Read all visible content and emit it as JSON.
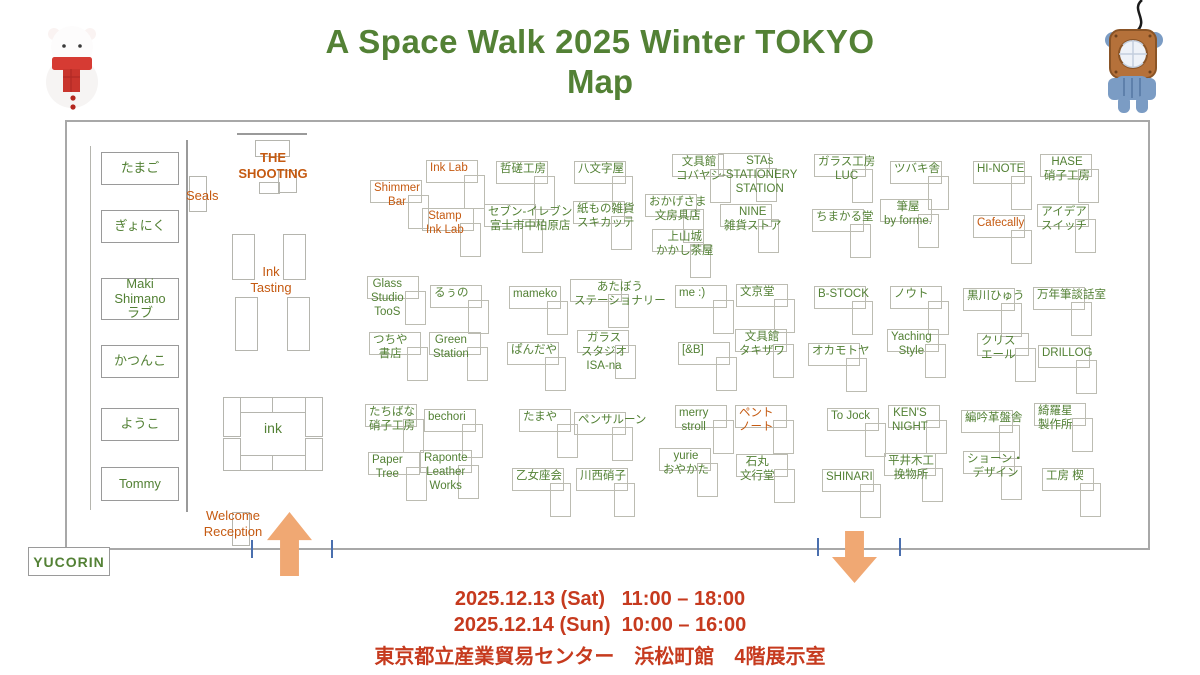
{
  "title": {
    "line1": "A Space Walk 2025 Winter TOKYO",
    "line2": "Map"
  },
  "colors": {
    "green": "#538135",
    "orange": "#c55a11",
    "red": "#c63a1e",
    "arrow_fill": "#f0a873",
    "tick_blue": "#4a6fae",
    "border_gray": "#a8a8a8"
  },
  "footer": {
    "date_sat": "2025.12.13 (Sat)   11:00 – 18:00",
    "date_sun": "2025.12.14 (Sun)  10:00 – 16:00",
    "venue": "東京都立産業貿易センター　浜松町館　4階展示室"
  },
  "map": {
    "labels": {
      "seals": "Seals",
      "shooting": "THE\nSHOOTING",
      "ink_tasting": "Ink\nTasting",
      "ink_table": "ink",
      "welcome": "Welcome\nReception",
      "yucorin": "YUCORIN"
    },
    "left_column": [
      {
        "label": "たまご",
        "y": 152,
        "h": 33
      },
      {
        "label": "ぎょにく",
        "y": 210,
        "h": 33
      },
      {
        "label": "Maki Shimano\nラブ",
        "y": 278,
        "h": 42
      },
      {
        "label": "かつんこ",
        "y": 345,
        "h": 33
      },
      {
        "label": "ようこ",
        "y": 408,
        "h": 33
      },
      {
        "label": "Tommy",
        "y": 467,
        "h": 34
      }
    ],
    "booths": [
      {
        "name": "Ink Lab",
        "color": "orange",
        "x": 430,
        "y": 162
      },
      {
        "name": "哲磋工房",
        "color": "green",
        "x": 500,
        "y": 163
      },
      {
        "name": "八文字屋",
        "color": "green",
        "x": 578,
        "y": 163
      },
      {
        "name": "文具館\nコバヤシ",
        "color": "green",
        "x": 676,
        "y": 156
      },
      {
        "name": "STAs\n-STATIONERY\nSTATION",
        "color": "green",
        "x": 722,
        "y": 155
      },
      {
        "name": "ガラス工房\nLUC",
        "color": "green",
        "x": 818,
        "y": 156
      },
      {
        "name": "ツバキ舎",
        "color": "green",
        "x": 894,
        "y": 163
      },
      {
        "name": "HI-NOTE",
        "color": "green",
        "x": 977,
        "y": 163
      },
      {
        "name": "HASE\n硝子工房",
        "color": "green",
        "x": 1044,
        "y": 156
      },
      {
        "name": "Shimmer\nBar",
        "color": "orange",
        "x": 374,
        "y": 182
      },
      {
        "name": "Stamp\nInk Lab",
        "color": "orange",
        "x": 426,
        "y": 210
      },
      {
        "name": "セブン‐イレブン\n富士市中柏原店",
        "color": "green",
        "x": 488,
        "y": 206
      },
      {
        "name": "紙もの雑貨\nスキカッテ",
        "color": "green",
        "x": 577,
        "y": 203
      },
      {
        "name": "おかげさま\n文房具店",
        "color": "green",
        "x": 649,
        "y": 196
      },
      {
        "name": "上山城\nかかし茶屋",
        "color": "green",
        "x": 656,
        "y": 231
      },
      {
        "name": "NINE\n雑貨ストア",
        "color": "green",
        "x": 724,
        "y": 206
      },
      {
        "name": "ちまかる堂",
        "color": "green",
        "x": 816,
        "y": 211
      },
      {
        "name": "筆屋\nby forme.",
        "color": "green",
        "x": 884,
        "y": 201
      },
      {
        "name": "Cafecally",
        "color": "orange",
        "x": 977,
        "y": 217
      },
      {
        "name": "アイデア\nスイッチ",
        "color": "green",
        "x": 1041,
        "y": 206
      },
      {
        "name": "Glass\nStudio\nTooS",
        "color": "green",
        "x": 371,
        "y": 278
      },
      {
        "name": "るぅの",
        "color": "green",
        "x": 434,
        "y": 287
      },
      {
        "name": "mameko",
        "color": "green",
        "x": 513,
        "y": 288
      },
      {
        "name": "あたぼう\nステーショナリー",
        "color": "green",
        "x": 574,
        "y": 281
      },
      {
        "name": "me :)",
        "color": "green",
        "x": 679,
        "y": 287
      },
      {
        "name": "文京堂",
        "color": "green",
        "x": 740,
        "y": 286
      },
      {
        "name": "B-STOCK",
        "color": "green",
        "x": 818,
        "y": 288
      },
      {
        "name": "ノウト",
        "color": "green",
        "x": 894,
        "y": 288
      },
      {
        "name": "黒川ひゅう",
        "color": "green",
        "x": 967,
        "y": 290
      },
      {
        "name": "万年筆談話室",
        "color": "green",
        "x": 1037,
        "y": 289
      },
      {
        "name": "つちや\n書店",
        "color": "green",
        "x": 373,
        "y": 334
      },
      {
        "name": "Green\nStation",
        "color": "green",
        "x": 433,
        "y": 334
      },
      {
        "name": "ぱんだや",
        "color": "green",
        "x": 511,
        "y": 344
      },
      {
        "name": "ガラス\nスタジオ\nISA-na",
        "color": "green",
        "x": 581,
        "y": 332
      },
      {
        "name": "[&B]",
        "color": "green",
        "x": 682,
        "y": 344
      },
      {
        "name": "文具館\nタキザワ",
        "color": "green",
        "x": 739,
        "y": 331
      },
      {
        "name": "オカモトヤ",
        "color": "green",
        "x": 812,
        "y": 345
      },
      {
        "name": "Yaching\nStyle",
        "color": "green",
        "x": 891,
        "y": 331
      },
      {
        "name": "クリス\nエール",
        "color": "green",
        "x": 981,
        "y": 335
      },
      {
        "name": "DRILLOG",
        "color": "green",
        "x": 1042,
        "y": 347
      },
      {
        "name": "たちばな\n硝子工房",
        "color": "green",
        "x": 369,
        "y": 406
      },
      {
        "name": "bechori",
        "color": "green",
        "x": 428,
        "y": 411
      },
      {
        "name": "たまや",
        "color": "green",
        "x": 523,
        "y": 411
      },
      {
        "name": "ペンサルーン",
        "color": "green",
        "x": 578,
        "y": 414
      },
      {
        "name": "merry\nstroll",
        "color": "green",
        "x": 679,
        "y": 407
      },
      {
        "name": "ペント\nノート",
        "color": "orange",
        "x": 739,
        "y": 407
      },
      {
        "name": "To Jock",
        "color": "green",
        "x": 831,
        "y": 410
      },
      {
        "name": "KEN'S\nNIGHT",
        "color": "green",
        "x": 892,
        "y": 407
      },
      {
        "name": "編吟革盤舎",
        "color": "green",
        "x": 965,
        "y": 412
      },
      {
        "name": "綺羅星\n製作所",
        "color": "green",
        "x": 1038,
        "y": 405
      },
      {
        "name": "Paper\nTree",
        "color": "green",
        "x": 372,
        "y": 454
      },
      {
        "name": "Raponte\nLeather\nWorks",
        "color": "green",
        "x": 424,
        "y": 452
      },
      {
        "name": "乙女座会",
        "color": "green",
        "x": 516,
        "y": 470
      },
      {
        "name": "川西硝子",
        "color": "green",
        "x": 580,
        "y": 470
      },
      {
        "name": "yurie\nおやかた",
        "color": "green",
        "x": 663,
        "y": 450
      },
      {
        "name": "石丸\n文行堂",
        "color": "green",
        "x": 740,
        "y": 456
      },
      {
        "name": "SHINARI",
        "color": "green",
        "x": 826,
        "y": 471
      },
      {
        "name": "平井木工\n挽物所",
        "color": "green",
        "x": 888,
        "y": 455
      },
      {
        "name": "ショーン・\nデザイン",
        "color": "green",
        "x": 967,
        "y": 453
      },
      {
        "name": "工房 楔",
        "color": "green",
        "x": 1046,
        "y": 470
      }
    ]
  }
}
